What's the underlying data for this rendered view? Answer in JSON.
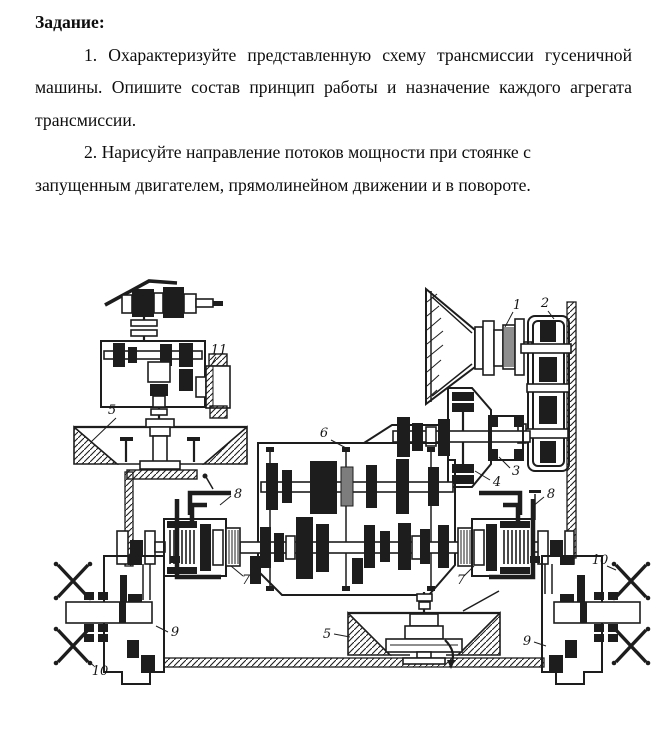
{
  "page": {
    "heading": "Задание:",
    "task1_lines": [
      "1. Охарактеризуйте представленную схему трансмиссии гусеничной",
      "машины. Опишите состав принцип работы и назначение каждого агрегата",
      "трансмиссии."
    ],
    "task2_lines": [
      "2. Нарисуйте направление потоков мощности при стоянке с",
      "запущенным двигателем, прямолинейном движении и в повороте."
    ]
  },
  "diagram": {
    "labels": [
      "1",
      "2",
      "3",
      "4",
      "5",
      "5",
      "6",
      "7",
      "7",
      "8",
      "8",
      "9",
      "9",
      "10",
      "10",
      "11"
    ],
    "colors": {
      "ink": "#1d1d1d",
      "paper": "#ffffff"
    }
  }
}
